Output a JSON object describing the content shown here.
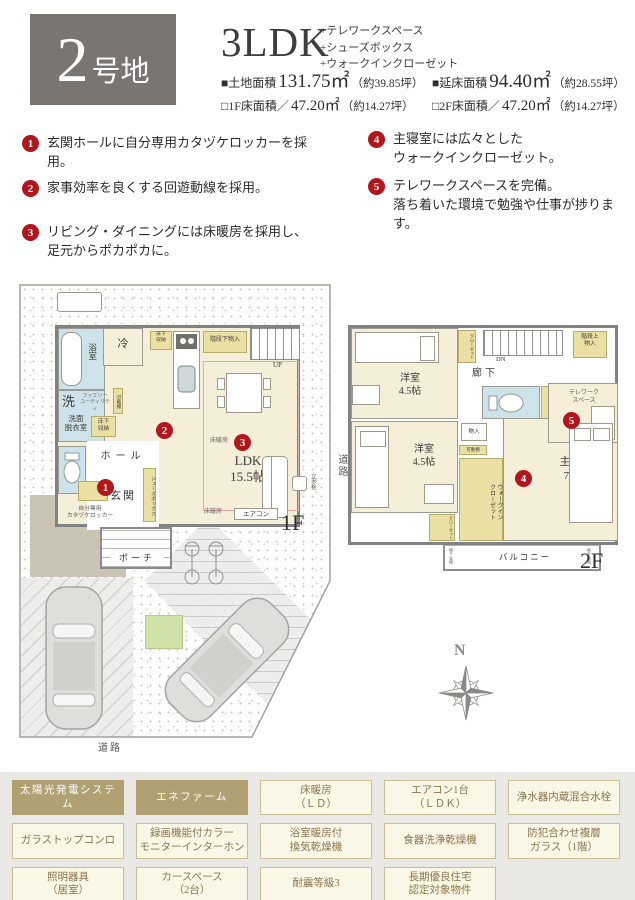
{
  "header": {
    "lot_big": "2",
    "lot_small": "号地",
    "title": "3LDK",
    "features": [
      "+テレワークスペース",
      "+シューズボックス",
      "+ウォークインクローゼット"
    ],
    "areas": [
      {
        "label": "■土地面積",
        "value": "131.75㎡",
        "note": "（約39.85坪）"
      },
      {
        "label": "■延床面積",
        "value": "94.40㎡",
        "note": "（約28.55坪）"
      },
      {
        "label": "□1F床面積／",
        "value": "47.20㎡",
        "note": "（約14.27坪）"
      },
      {
        "label": "□2F床面積／",
        "value": "47.20㎡",
        "note": "（約14.27坪）"
      }
    ]
  },
  "points": [
    {
      "num": "1",
      "text": "玄関ホールに自分専用カタヅケロッカーを採用。"
    },
    {
      "num": "2",
      "text": "家事効率を良くする回遊動線を採用。"
    },
    {
      "num": "3",
      "text": "リビング・ダイニングには床暖房を採用し、\n足元からポカポカに。"
    },
    {
      "num": "4",
      "text": "主寝室には広々とした\nウォークインクローゼット。"
    },
    {
      "num": "5",
      "text": "テレワークスペースを完備。\n落ち着いた環境で勉強や仕事が捗ります。"
    }
  ],
  "plan1f": {
    "bath": "浴室",
    "wash": "洗",
    "family_utility": "ファミリー\nユーティリティ",
    "laundry_room": "洗面\n脱衣室",
    "underfloor1": "床下\n収納",
    "underfloor2": "床下\n収納",
    "fridge": "冷",
    "stair_storage": "階段下物入",
    "up": "UP",
    "movable_shelf": "可動棚",
    "hall": "ホール",
    "entrance": "玄関",
    "porch": "ポーチ",
    "shoe_box": "シューズボックス",
    "locker": "自分専用\nカタヅケロッカー",
    "ldk": "LDK\n15.5帖",
    "floor_heating1": "床暖房",
    "floor_heating2": "床暖房",
    "aircon": "エアコン",
    "faucet": "立水栓",
    "floor": "1F",
    "road_side": "道路",
    "road_bottom": "道路"
  },
  "plan2f": {
    "bedroom1": "洋室\n4.5帖",
    "bedroom2": "洋室\n4.5帖",
    "closet_top": "クローゼット",
    "closet_small": "クローゼット",
    "stair_storage": "階段上\n物入",
    "dn": "DN",
    "corridor": "廊下",
    "telework": "テレワーク\nスペース",
    "storage": "物入",
    "movable_shelf": "可動棚",
    "wic": "ウォークイン\nクローゼット",
    "master": "主寝室\n7.3帖",
    "balcony": "バルコニー",
    "laundry_hw1": "物干金物",
    "laundry_hw2": "物干金物",
    "floor": "2F"
  },
  "compass": {
    "north": "N"
  },
  "equipment": {
    "cells": [
      {
        "label": "太陽光発電システム"
      },
      {
        "label": "エネファーム"
      },
      {
        "label": "床暖房\n（ＬＤ）"
      },
      {
        "label": "エアコン1台\n（ＬＤＫ）"
      },
      {
        "label": "浄水器内蔵混合水栓"
      },
      {
        "label": "ガラストップコンロ"
      },
      {
        "label": "録画機能付カラー\nモニターインターホン"
      },
      {
        "label": "浴室暖房付\n換気乾燥機"
      },
      {
        "label": "食器洗浄乾燥機"
      },
      {
        "label": "防犯合わせ複層\nガラス（1階）"
      },
      {
        "label": "照明器具\n（居室）"
      },
      {
        "label": "カースペース\n（2台）"
      },
      {
        "label": "耐震等級3"
      },
      {
        "label": "長期優良住宅\n認定対象物件"
      }
    ]
  }
}
